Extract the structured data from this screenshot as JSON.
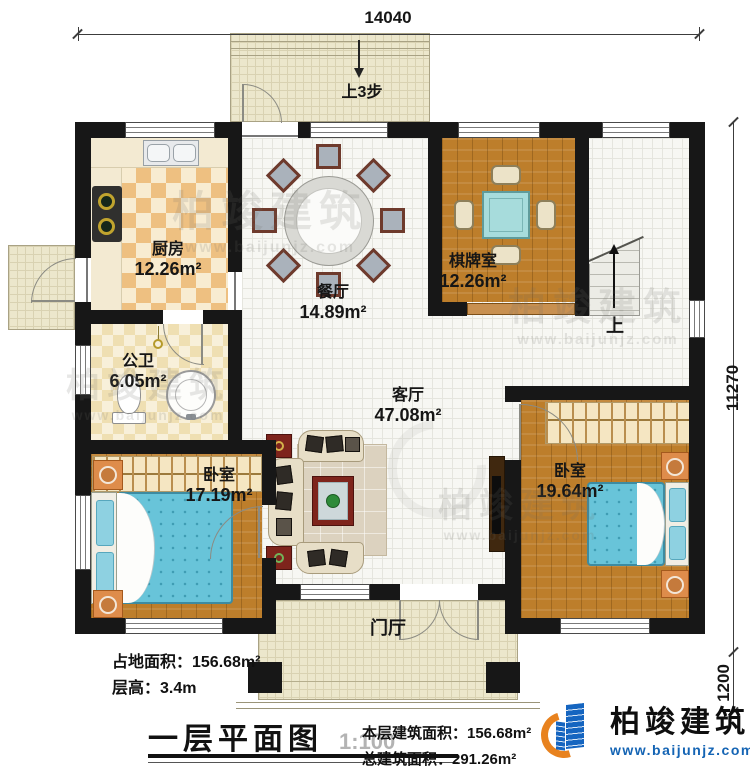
{
  "dimensions": {
    "top": "14040",
    "right_main": "11270",
    "right_lower": "1200"
  },
  "rooms": {
    "kitchen": {
      "name": "厨房",
      "area": "12.26m²"
    },
    "dining": {
      "name": "餐厅",
      "area": "14.89m²"
    },
    "chess": {
      "name": "棋牌室",
      "area": "12.26m²"
    },
    "bath": {
      "name": "公卫",
      "area": "6.05m²"
    },
    "living": {
      "name": "客厅",
      "area": "47.08m²"
    },
    "bedroom_left": {
      "name": "卧室",
      "area": "17.19m²"
    },
    "bedroom_right": {
      "name": "卧室",
      "area": "19.64m²"
    },
    "foyer": {
      "name": "门厅"
    }
  },
  "annotations": {
    "steps_up": "上3步",
    "stairs_up": "上"
  },
  "info": {
    "land_area": "占地面积：156.68m²",
    "floor_height": "层高：3.4m",
    "title": "一层平面图",
    "scale": "1:100",
    "floor_area": "本层建筑面积：156.68m²",
    "total_area": "总建筑面积：291.26m²"
  },
  "logo": {
    "name": "柏竣建筑",
    "url": "www.baijunjz.com"
  },
  "watermark": {
    "name": "柏竣建筑",
    "url": "www.baijunjz.com"
  },
  "colors": {
    "wall": "#171717",
    "wood": "#bd7e2b",
    "accent_blue": "#1565c0",
    "accent_orange": "#e8821e",
    "bed": "#68c4d9"
  }
}
